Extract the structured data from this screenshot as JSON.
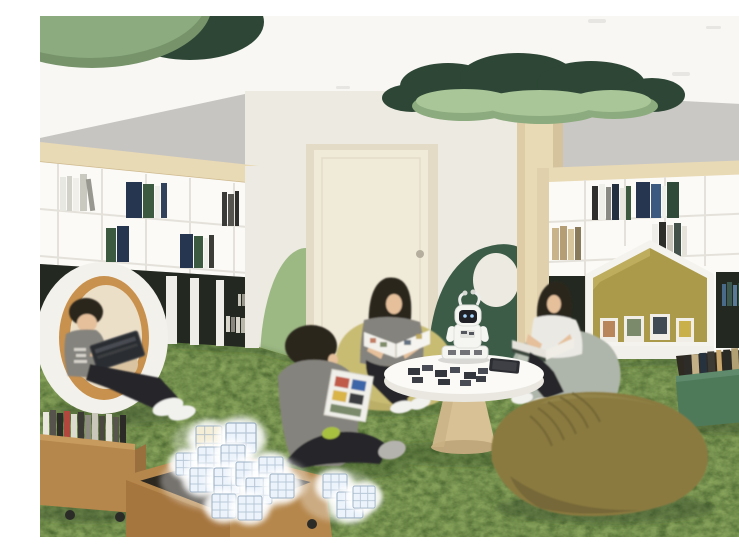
{
  "scene": {
    "type": "interior-rendering",
    "description": "Rendering of a children's library reading room: green grass-like carpet, white bookshelves, house-shaped reading nook, round pod chair, acoustic green ceiling canopies on a wooden tree column, four young readers on bean bags, a small white social robot on a round table, and crates of glowing cube blocks.",
    "objects": [
      {
        "name": "ceiling-canopy-left",
        "label": "sage and dark green ceiling discs"
      },
      {
        "name": "ceiling-canopy-tree",
        "label": "clover-shaped green canopy on a wooden column"
      },
      {
        "name": "bookshelf-left",
        "label": "white bookshelf wall with wood top band and dark base cabinets"
      },
      {
        "name": "reading-pod",
        "label": "round pod chair with orange rim"
      },
      {
        "name": "pod-reader",
        "label": "boy reading a tablet inside the pod"
      },
      {
        "name": "door",
        "label": "cream interior door with round handle"
      },
      {
        "name": "wall-hill-left",
        "label": "sage green hill-shaped wall panel"
      },
      {
        "name": "wall-hill-right",
        "label": "dark green hill-shaped wall panel"
      },
      {
        "name": "bookshelf-right",
        "label": "white bookshelf with house-shaped reading nook"
      },
      {
        "name": "reading-nook",
        "label": "house-shaped nook displaying picture books"
      },
      {
        "name": "round-table",
        "label": "white round table on wooden pedestal"
      },
      {
        "name": "robot",
        "label": "small white social robot with black face screen"
      },
      {
        "name": "woman-reading",
        "label": "woman reading a magazine on a mustard bean bag"
      },
      {
        "name": "girl-reading",
        "label": "girl reading a book on a gray bean bag"
      },
      {
        "name": "boy-floor",
        "label": "boy sitting cross-legged holding an activity board"
      },
      {
        "name": "beanbag-olive",
        "label": "large olive bean bag in foreground"
      },
      {
        "name": "crate-books-left",
        "label": "wooden book crate on casters"
      },
      {
        "name": "crate-blocks",
        "label": "wooden crate filled with glowing cube blocks"
      },
      {
        "name": "crate-books-green",
        "label": "green book crate on casters"
      },
      {
        "name": "glowing-cubes",
        "label": "illuminated cube blocks on the carpet"
      },
      {
        "name": "carpet",
        "label": "mottled green grass carpet"
      }
    ]
  },
  "palette": {
    "ceiling": "#f8f7f3",
    "wall_side": "#c7c5c1",
    "wall_back": "#edeae2",
    "wall_right": "#c9c8c4",
    "canopy_dark": "#2d4635",
    "canopy_sage": "#8cab7e",
    "canopy_sage_rim": "#76936a",
    "canopy_light": "#a9c699",
    "wood_light": "#e9dab6",
    "wood_mid": "#d8c194",
    "shelf_white": "#fbfaf6",
    "shelf_line": "#e4e1da",
    "cabinet_dark": "#232920",
    "carpet_green": "#74904c",
    "door_cream": "#f0ead8",
    "door_frame": "#e3dbc5",
    "hill_sage": "#9cb883",
    "hill_dark": "#3c5c48",
    "pod_white": "#f3f1eb",
    "pod_rim_orange": "#c8914e",
    "pod_inner_cream": "#ecdfc8",
    "nook_olive": "#aa9a49",
    "beanbag_mustard": "#c8bc73",
    "beanbag_gray": "#aeb5aa",
    "beanbag_olive": "#8a7a3f",
    "crate_wood": "#b5874c",
    "crate_wood_dark": "#996f3e",
    "crate_green": "#4e7a5a",
    "table_white": "#fbfaf7",
    "robot_white": "#f5f5f2",
    "robot_dark": "#1f2126",
    "hair_dark": "#2a251f",
    "skin": "#e5c09b",
    "shirt_gray": "#85837d",
    "shirt_white": "#eae9e4",
    "pants_black": "#25252b",
    "shoe_white": "#f1f1ee",
    "cube_cool": "#ecf3fb",
    "cube_warm": "#f5eed7",
    "cube_line": "#9cb1c4",
    "book_navy": "#263650",
    "book_green": "#3c5a40",
    "tablet_dark": "#2b2d32"
  }
}
